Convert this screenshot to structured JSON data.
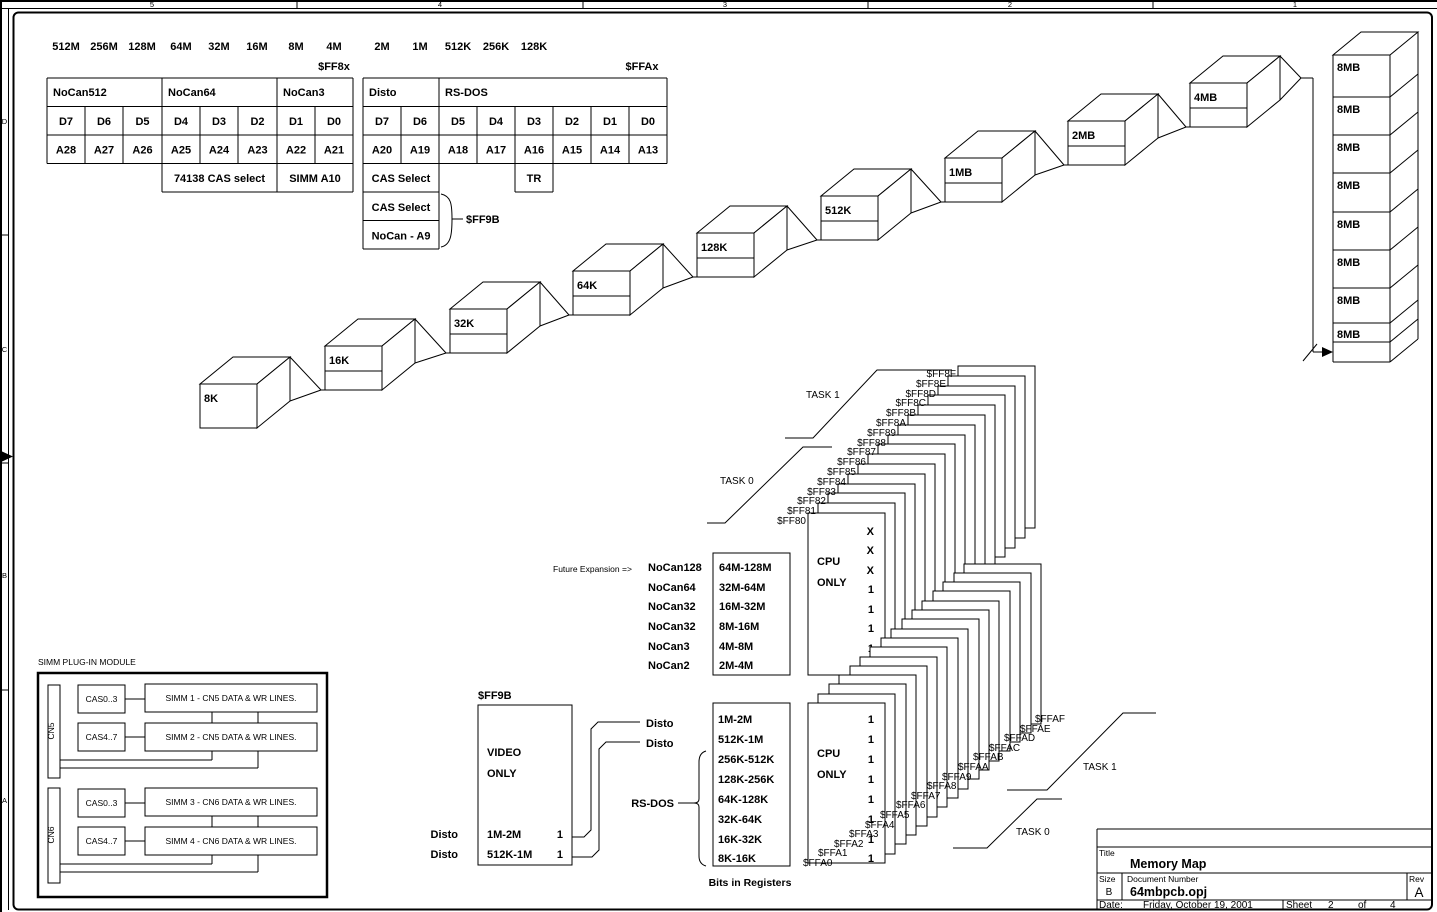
{
  "ruler": {
    "top": [
      "5",
      "4",
      "3",
      "2",
      "1"
    ],
    "left": [
      "D",
      "C",
      "B",
      "A"
    ]
  },
  "size_labels": [
    "512M",
    "256M",
    "128M",
    "64M",
    "32M",
    "16M",
    "8M",
    "4M",
    "2M",
    "1M",
    "512K",
    "256K",
    "128K"
  ],
  "reg_group_hi": "$FF8x",
  "reg_group_lo": "$FFAx",
  "t1": {
    "g0": "NoCan512",
    "g1": "NoCan64",
    "g2": "NoCan3",
    "d": [
      "D7",
      "D6",
      "D5",
      "D4",
      "D3",
      "D2",
      "D1",
      "D0"
    ],
    "a": [
      "A28",
      "A27",
      "A26",
      "A25",
      "A24",
      "A23",
      "A22",
      "A21"
    ],
    "f0": "74138 CAS select",
    "f1": "SIMM A10"
  },
  "t2": {
    "g0": "Disto",
    "g1": "RS-DOS",
    "d": [
      "D7",
      "D6",
      "D5",
      "D4",
      "D3",
      "D2",
      "D1",
      "D0"
    ],
    "a": [
      "A20",
      "A19",
      "A18",
      "A17",
      "A16",
      "A15",
      "A14",
      "A13"
    ],
    "cas1": "CAS Select",
    "tr": "TR",
    "cas2": "CAS Select",
    "nocan": "NoCan - A9",
    "ref": "$FF9B"
  },
  "cascade": [
    "8K",
    "16K",
    "32K",
    "64K",
    "128K",
    "512K",
    "1MB",
    "2MB",
    "4MB"
  ],
  "banks": [
    "8MB",
    "8MB",
    "8MB",
    "8MB",
    "8MB",
    "8MB",
    "8MB",
    "8MB"
  ],
  "regs_hi": [
    "$FF80",
    "$FF81",
    "$FF82",
    "$FF83",
    "$FF84",
    "$FF85",
    "$FF86",
    "$FF87",
    "$FF88",
    "$FF89",
    "$FF8A",
    "$FF8B",
    "$FF8C",
    "$FF8D",
    "$FF8E",
    "$FF8F"
  ],
  "regs_lo": [
    "$FFA0",
    "$FFA1",
    "$FFA2",
    "$FFA3",
    "$FFA4",
    "$FFA5",
    "$FFA6",
    "$FFA7",
    "$FFA8",
    "$FFA9",
    "$FFAA",
    "$FFAB",
    "$FFAC",
    "$FFAD",
    "$FFAE",
    "$FFAF"
  ],
  "tasks": {
    "t1": "TASK 1",
    "t0": "TASK 0"
  },
  "future": "Future Expansion =>",
  "exp_names": [
    "NoCan128",
    "NoCan64",
    "NoCan32",
    "NoCan32",
    "NoCan3",
    "NoCan2"
  ],
  "exp_ranges": [
    "64M-128M",
    "32M-64M",
    "16M-32M",
    "8M-16M",
    "4M-8M",
    "2M-4M"
  ],
  "cpu_hi": {
    "l1": "CPU",
    "l2": "ONLY",
    "vals": [
      "X",
      "X",
      "X",
      "1",
      "1",
      "1",
      "1",
      "1"
    ]
  },
  "cpu_lo": {
    "l1": "CPU",
    "l2": "ONLY",
    "vals": [
      "1",
      "1",
      "1",
      "1",
      "1",
      "1",
      "1",
      "1"
    ]
  },
  "ranges_lo": [
    "1M-2M",
    "512K-1M",
    "256K-512K",
    "128K-256K",
    "64K-128K",
    "32K-64K",
    "16K-32K",
    "8K-16K"
  ],
  "leaders": {
    "disto1": "Disto",
    "disto2": "Disto",
    "rsdos": "RS-DOS"
  },
  "bits_caption": "Bits in Registers",
  "ff9b": {
    "title": "$FF9B",
    "v1": "VIDEO",
    "v2": "ONLY",
    "r1_label": "Disto",
    "r1_range": "1M-2M",
    "r1_val": "1",
    "r2_label": "Disto",
    "r2_range": "512K-1M",
    "r2_val": "1"
  },
  "simm": {
    "title": "SIMM PLUG-IN MODULE",
    "cn5": "CN5",
    "cn6": "CN6",
    "cas": [
      "CAS0..3",
      "CAS4..7",
      "CAS0..3",
      "CAS4..7"
    ],
    "rows": [
      "SIMM 1 - CN5 DATA & WR LINES.",
      "SIMM 2 - CN5 DATA & WR LINES.",
      "SIMM 3 - CN6 DATA & WR LINES.",
      "SIMM 4 - CN6 DATA & WR LINES."
    ]
  },
  "tb": {
    "title_label": "Title",
    "title": "Memory Map",
    "size_label": "Size",
    "size": "B",
    "doc_label": "Document Number",
    "doc": "64mbpcb.opj",
    "rev_label": "Rev",
    "rev": "A",
    "date_label": "Date:",
    "date": "Friday, October 19, 2001",
    "sheet_label": "Sheet",
    "sheet": "2",
    "of": "of",
    "total": "4"
  }
}
